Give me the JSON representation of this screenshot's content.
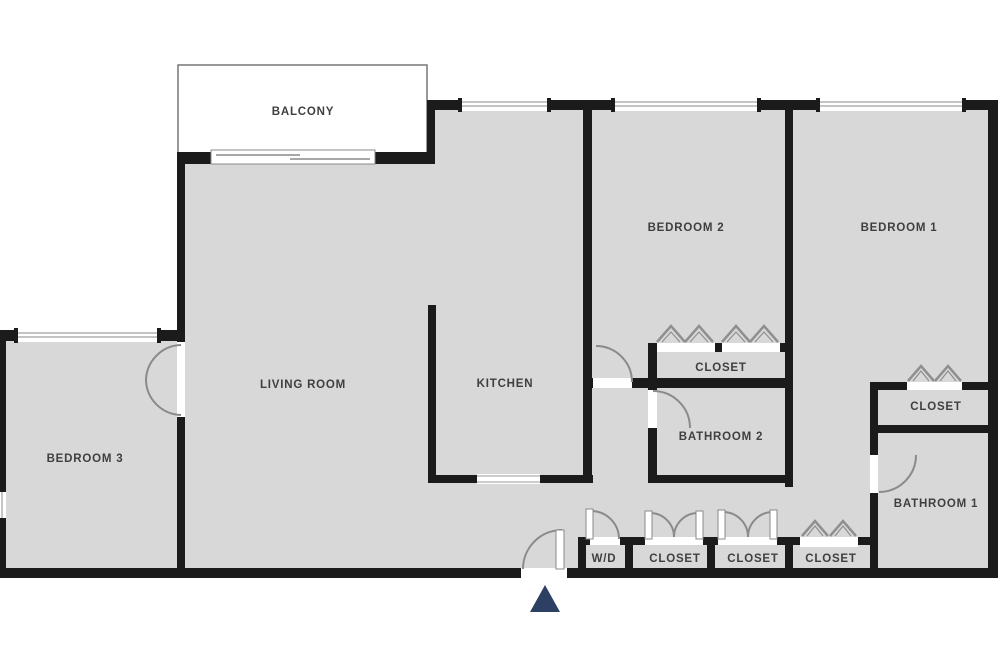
{
  "plan": {
    "type": "apartment-floor-plan",
    "rooms": {
      "balcony": {
        "label": "BALCONY"
      },
      "living_room": {
        "label": "LIVING ROOM"
      },
      "kitchen": {
        "label": "KITCHEN"
      },
      "bedroom_1": {
        "label": "BEDROOM 1"
      },
      "bedroom_2": {
        "label": "BEDROOM 2"
      },
      "bedroom_3": {
        "label": "BEDROOM 3"
      },
      "bathroom_1": {
        "label": "BATHROOM 1"
      },
      "bathroom_2": {
        "label": "BATHROOM 2"
      },
      "closet_bedroom_2": {
        "label": "CLOSET"
      },
      "closet_bedroom_1": {
        "label": "CLOSET"
      },
      "wd": {
        "label": "W/D"
      },
      "closet_hall_1": {
        "label": "CLOSET"
      },
      "closet_hall_2": {
        "label": "CLOSET"
      },
      "closet_vestibule": {
        "label": "CLOSET"
      }
    },
    "colors": {
      "wall": "#1b1b1b",
      "room_fill": "#d8d8d8",
      "exterior": "#ffffff",
      "door_swing": "#8a8a8a",
      "label_text": "#3f3f3f",
      "entry_arrow": "#2d3f63"
    }
  }
}
